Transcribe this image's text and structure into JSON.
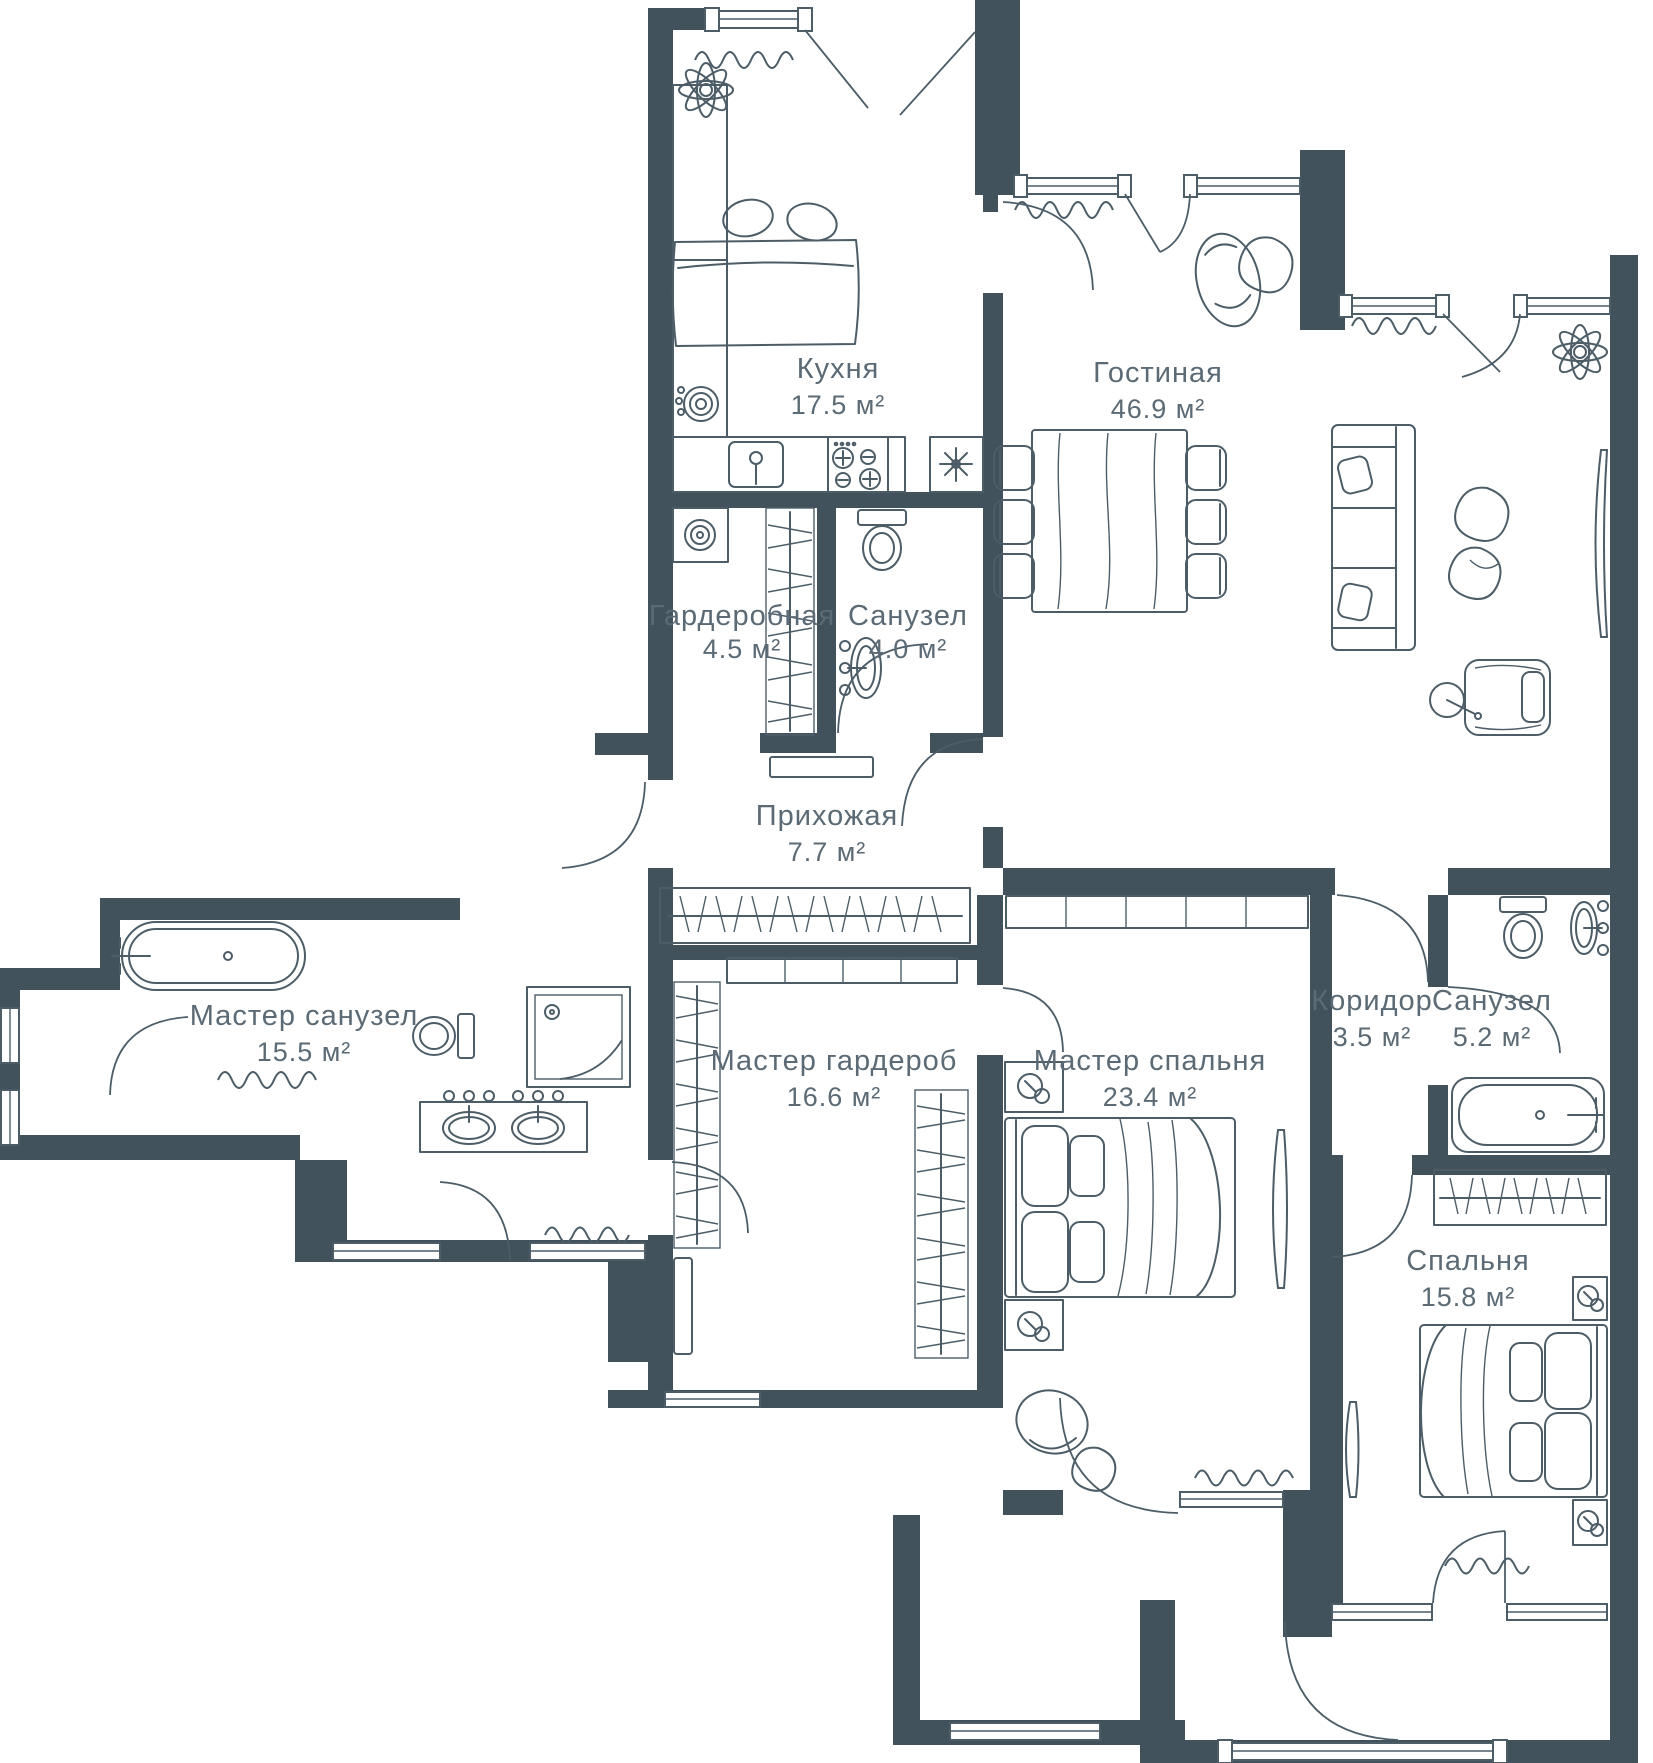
{
  "plan": {
    "type": "apartment-floor-plan",
    "units": "м²",
    "colors": {
      "wall": "#42525D",
      "line": "#4D5D68",
      "label": "#5B6A75",
      "background": "#FFFFFF"
    },
    "total_rooms": 11,
    "rooms": [
      {
        "id": "kitchen",
        "name": "Кухня",
        "area": "17.5 м²"
      },
      {
        "id": "living",
        "name": "Гостиная",
        "area": "46.9 м²"
      },
      {
        "id": "wardrobe",
        "name": "Гардеробная",
        "area": "4.5 м²"
      },
      {
        "id": "bath-small",
        "name": "Санузел",
        "area": "4.0 м²"
      },
      {
        "id": "hallway",
        "name": "Прихожая",
        "area": "7.7 м²"
      },
      {
        "id": "master-bath",
        "name": "Мастер санузел",
        "area": "15.5 м²"
      },
      {
        "id": "master-wardrobe",
        "name": "Мастер гардероб",
        "area": "16.6 м²"
      },
      {
        "id": "master-bedroom",
        "name": "Мастер спальня",
        "area": "23.4 м²"
      },
      {
        "id": "corridor",
        "name": "Коридор",
        "area": "3.5 м²"
      },
      {
        "id": "bath-52",
        "name": "Санузел",
        "area": "5.2 м²"
      },
      {
        "id": "bedroom",
        "name": "Спальня",
        "area": "15.8 м²"
      }
    ]
  }
}
